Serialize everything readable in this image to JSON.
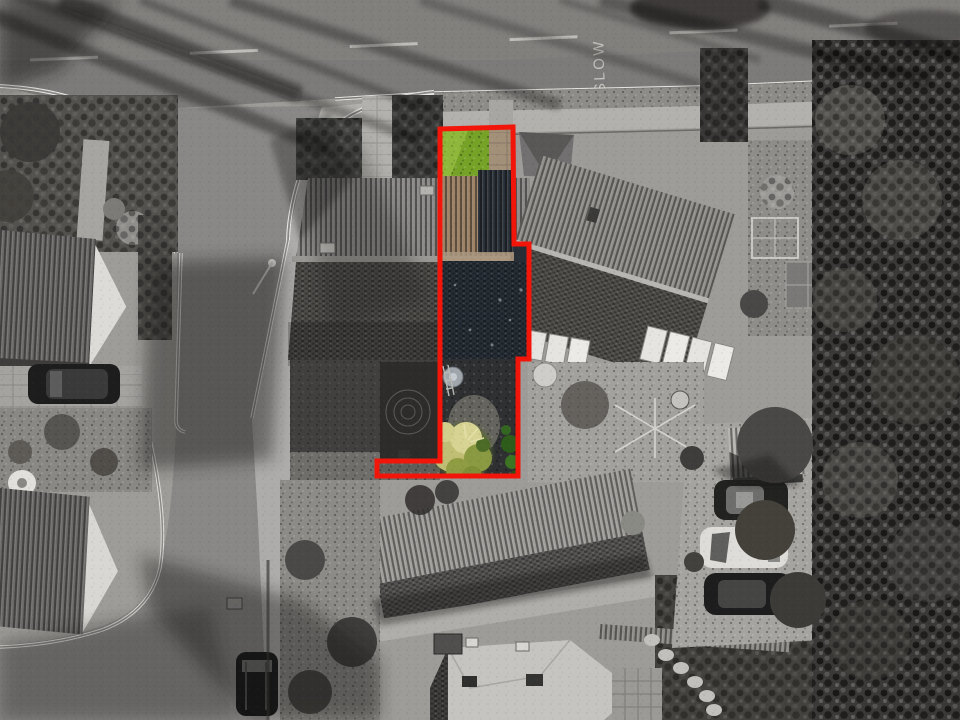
{
  "annotation": {
    "type": "property-plot-boundary-overlay",
    "road_marking": "SLOW",
    "boundary": {
      "points": "440,129 513,127 514,244 529,244 529,359 518,359 518,476 377,476 377,461 440,461",
      "stroke_width": 5
    }
  },
  "colors": {
    "boundary_red": "#f2150a",
    "grass_green": "#76a228",
    "grass_light": "#a4c84b",
    "roof_tan": "#9c8164",
    "gutter_tan": "#ab977c",
    "slate_dark": "#272e36",
    "patio_dark": "#2e3032",
    "gravel_light": "#6f6d66",
    "tree_yellow": "#c0bd74",
    "tree_yellow_light": "#d7d493",
    "tree_green": "#8a9a42",
    "bush_green": "#2e5c1b",
    "path_tan": "#a39079",
    "notch_gray": "#605e59",
    "road_gray": "#7d7b79",
    "side_road_gray": "#8a8886",
    "pavement_gray": "#b3b1ad",
    "verge_gray": "#8e8c88",
    "roof_rib_light": "#8b8987",
    "roof_slope_dark": "#4f4d4a",
    "roof_pale": "#c6c4c0",
    "gable_white": "#dddbd7",
    "foliage_dark": "#3b3937",
    "car_dark": "#1d1d1d",
    "car_white": "#dedcd8",
    "curb_white": "#e8e6e2",
    "shed_gray": "#b7b5b1"
  },
  "scene": {
    "description": "Grayscale aerial drone photograph of a residential street. A red boundary line marks a long narrow plot over one half of a semi-detached house: its front lawn, roof strip and rear garden stay in colour while everything else is monochrome.",
    "objects": [
      "main-road",
      "side-road",
      "slow-road-marking",
      "left-houses",
      "subject-semi-detached-house",
      "right-house",
      "rear-garage",
      "bottom-house",
      "parked-cars",
      "tree-belt",
      "red-plot-boundary"
    ]
  }
}
